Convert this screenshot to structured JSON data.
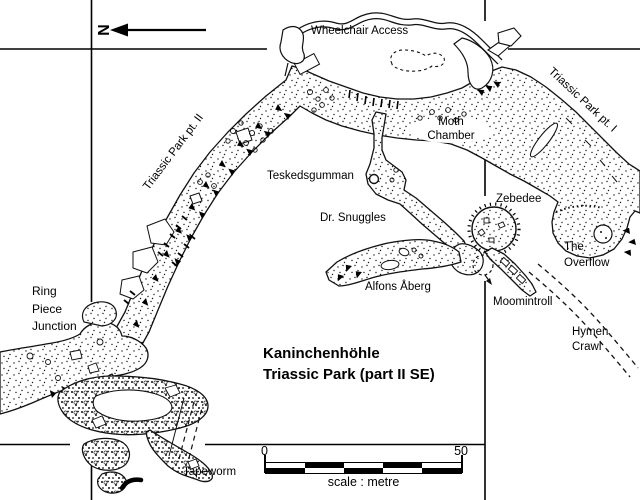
{
  "map": {
    "title": {
      "line1": "Kaninchenhöhle",
      "line2": "Triassic Park (part II SE)"
    },
    "compass": {
      "north_label": "N"
    },
    "scale_bar": {
      "start_value": "0",
      "end_value": "50",
      "caption": "scale : metre"
    },
    "labels": {
      "wheelchair_access": "Wheelchair Access",
      "triassic_park_pt2": "Triassic Park pt. II",
      "triassic_park_pt1": "Triassic Park pt. I",
      "moth_chamber": "Moth\nChamber",
      "teskedsgumman": "Teskedsgumman",
      "dr_snuggles": "Dr. Snuggles",
      "zebedee": "Zebedee",
      "alfons_aberg": "Alfons Åberg",
      "moomintroll": "Moomintroll",
      "the_overflow": "The\nOverflow",
      "hymen_crawl": "Hymen\nCrawl",
      "ring_piece_junction": "Ring\nPiece\nJunction",
      "tapeworm": "Tapeworm"
    }
  }
}
